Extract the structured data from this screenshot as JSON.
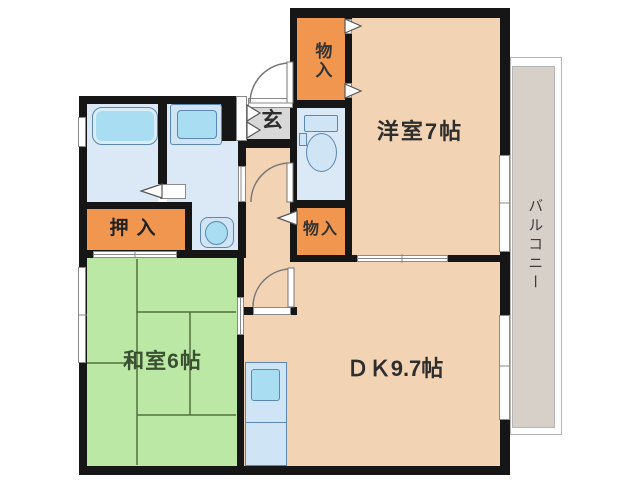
{
  "plan": {
    "type": "apartment-floor-plan",
    "labels": {
      "yoshitsu": "洋室7帖",
      "dk": "ＤＫ9.7帖",
      "washitsu": "和室6帖",
      "balcony": "バルコニー",
      "genkan": "玄",
      "monoire_top": "物入",
      "monoire_mid": "物入",
      "oshiire": "押入"
    },
    "fixtures": [
      "bathtub",
      "washing-machine",
      "washbasin",
      "toilet",
      "kitchen-sink",
      "shoe-cabinet",
      "entrance-door",
      "swing-doors",
      "sliding-doors",
      "folding-doors",
      "windows",
      "tatami-mats"
    ],
    "colors": {
      "wall_black": "#161616",
      "room_peach": "#f2d4b5",
      "storage_orange": "#f0964e",
      "tatami_green": "#bce8a6",
      "wet_blue": "#dbe9f7",
      "fixture_cyan": "#a9ddf1",
      "fixture_border": "#5c87b2",
      "balcony_taupe": "#d7d0c8",
      "genkan_gray": "#d8d8d8",
      "tatami_line": "#53703f"
    }
  }
}
